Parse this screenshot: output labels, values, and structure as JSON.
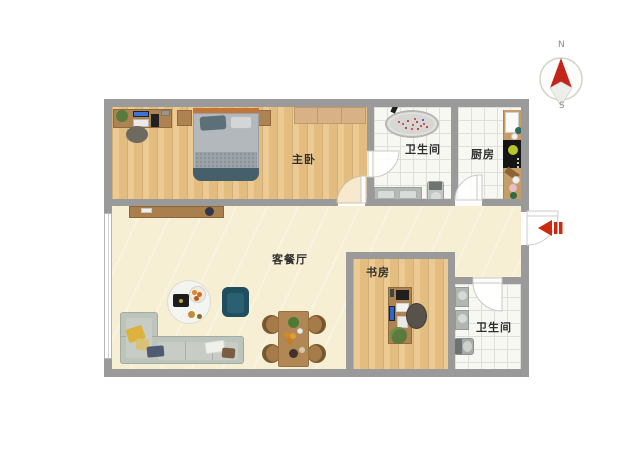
{
  "rooms": [
    {
      "key": "master_bedroom",
      "label": "主卧"
    },
    {
      "key": "bathroom_ensuite",
      "label": "卫生间"
    },
    {
      "key": "kitchen",
      "label": "厨房"
    },
    {
      "key": "living_dining",
      "label": "客餐厅"
    },
    {
      "key": "study",
      "label": "书房"
    },
    {
      "key": "bathroom_guest",
      "label": "卫生间"
    }
  ],
  "compass": {
    "north_label": "N",
    "south_label": "S"
  },
  "icons": {
    "compass": "compass-rose-icon",
    "entrance": "entrance-arrow-icon"
  },
  "colors": {
    "wall": "#9a9a9a",
    "bedroom_wood_floor": "#e7c189",
    "living_floor": "#f6efd3",
    "tile_floor": "#f8f8f2",
    "entrance_arrow_red": "#cc2a0e",
    "compass_north_red": "#c2251a",
    "sofa_gray_green": "#bdc4bc",
    "armchair_teal": "#1f4e5e",
    "furniture_wood": "#ad8352",
    "bed_duvet": "#aeb4b9",
    "bed_throw_teal": "#455f6b"
  }
}
